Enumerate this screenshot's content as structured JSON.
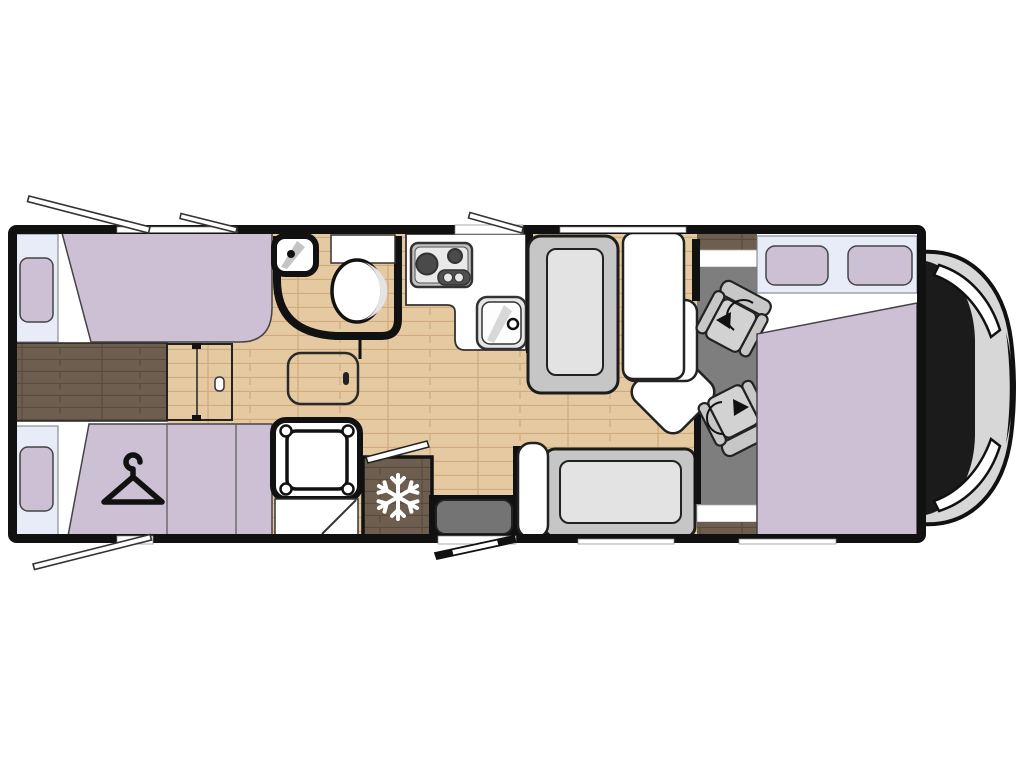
{
  "palette": {
    "purple": "#cdc0d5",
    "window_blue": "#e7ecf8",
    "wood_light": "#e5c9a1",
    "wood_light_grain": "#cfab7d",
    "wood_dark": "#6d5e4f",
    "wood_dark_grain": "#594b3d",
    "cab_floor_gray": "#7e7e7e",
    "bench_gray": "#c6c6c6",
    "cushion_gray": "#e3e3e3",
    "seat_gray": "#d2d2d2",
    "seat_back_gray": "#c7c7c7",
    "step_gray": "#747474",
    "vehicle_nose_gray": "#d7d7d7",
    "counter_white": "#ffffff",
    "appliance_gray": "#e9e9e9",
    "burner_dark": "#4a4a4a",
    "outline_black": "#111111"
  },
  "icons": {
    "wardrobe": "hanger-icon",
    "fridge": "snowflake-icon",
    "cab_seats": "rotation-arrow-icon"
  },
  "areas": [
    "rear-twin-beds",
    "wardrobe",
    "sliding-partition-door",
    "floor-hatch",
    "bathroom",
    "shower",
    "kitchen",
    "fridge",
    "entry-step",
    "dinette",
    "cab-swivel-seats",
    "drop-down-bed",
    "cab-front"
  ]
}
